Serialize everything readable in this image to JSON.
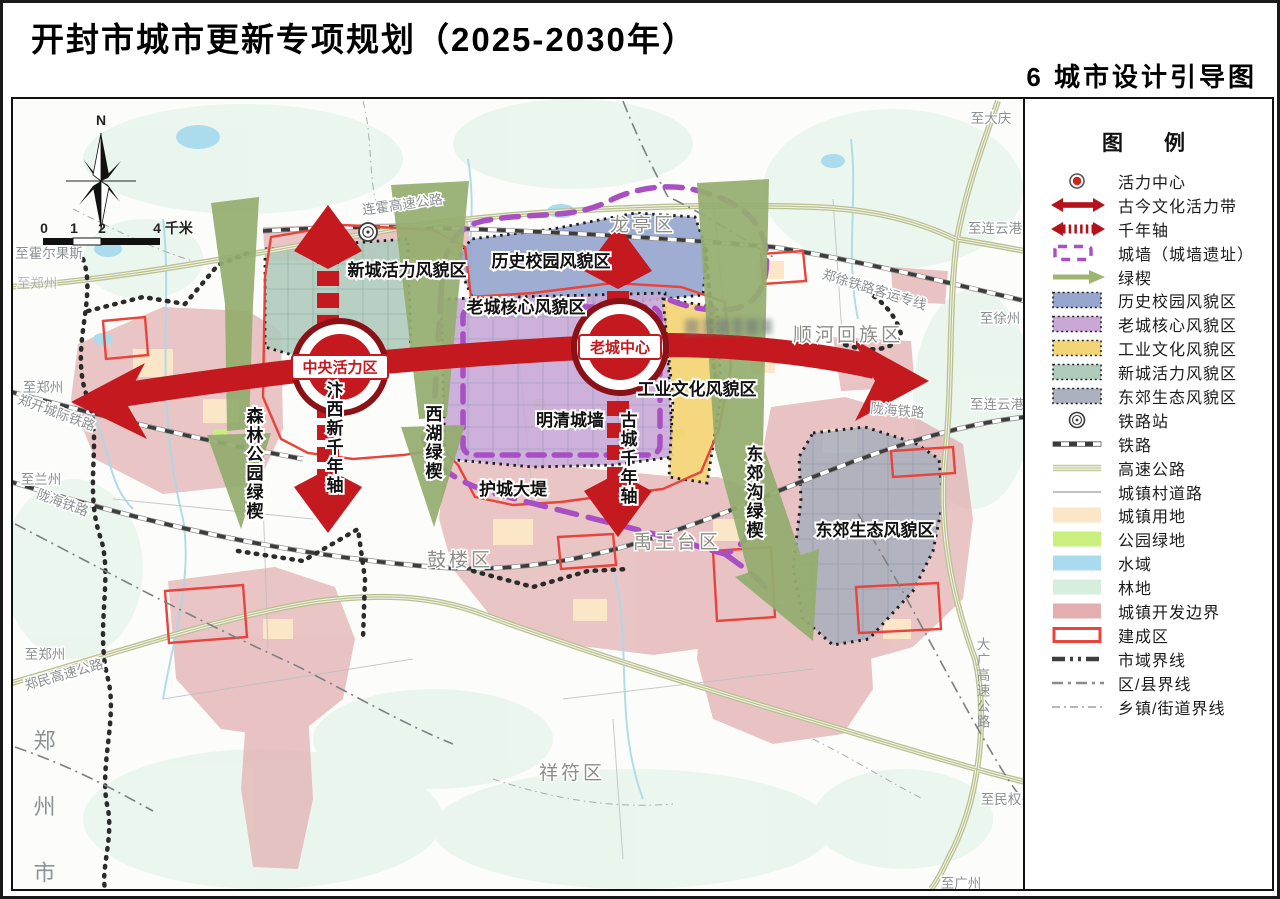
{
  "header": {
    "title": "开封市城市更新专项规划（2025-2030年）",
    "subtitle": "6 城市设计引导图"
  },
  "compass": {
    "north": "N"
  },
  "scale": {
    "t0": "0",
    "t1": "1",
    "t2": "2",
    "t4": "4 千米"
  },
  "map": {
    "zone_new_city": "新城活力风貌区",
    "zone_history_campus": "历史校园风貌区",
    "zone_old_core": "老城核心风貌区",
    "zone_industry": "工业文化风貌区",
    "wall_ming_qing": "明清城墙",
    "wall_moat_dike": "护城大堤",
    "zone_east_eco": "东郊生态风貌区",
    "wedge_forest": "森林公园绿楔",
    "axis_bianxi": "汴西新千年轴",
    "wedge_xihu": "西湖绿楔",
    "axis_gucheng": "古城千年轴",
    "wedge_dongjiaogou": "东郊沟绿楔",
    "center_cbd": "中央活力区",
    "center_old": "老城中心",
    "dist_longting": "龙亭区",
    "dist_shunhe": "顺河回族区",
    "dist_gulou": "鼓楼区",
    "dist_yuwangtai": "禹王台区",
    "dist_xiangfu": "祥符区",
    "city_zhengzhou": "郑州市",
    "rd_lianhuo": "连霍高速公路",
    "rail_zhengxu": "郑徐铁路客运专线",
    "rail_longhai_e": "陇海铁路",
    "rail_longhai_w": "陇海铁路",
    "rail_zhengkai": "郑开城际铁路",
    "rd_zhengmin": "郑民高速公路",
    "rd_daguang": "大广高速公路",
    "to_daqing": "至大庆",
    "to_lianyungang_n": "至连云港",
    "to_xuzhou": "至徐州",
    "to_lianyungang_s": "至连云港",
    "to_minquan": "至民权",
    "to_guangzhou": "至广州",
    "to_huoerguosi": "至霍尔果斯",
    "to_zhengzhou_n": "至郑州",
    "to_zhengzhou_m": "至郑州",
    "to_lanzhou": "至兰州",
    "to_zhengzhou_s": "至郑州"
  },
  "colors": {
    "red_axis": "#c3191f",
    "purple_wall": "#a84fc4",
    "green_wedge": "#94ad6f",
    "zone_history": "#97a6cf",
    "zone_oldcore": "#c9a8d6",
    "zone_industry": "#f3d578",
    "zone_newcity": "#afcbbc",
    "zone_easteco": "#acb0bf",
    "urban_land": "#fbe7c8",
    "park_green": "#c9f07e",
    "water": "#a9daee",
    "forest": "#d5eedd",
    "dev_boundary": "#e2aeb0",
    "built_outline": "#e8443b"
  },
  "legend": {
    "title": "图　例",
    "items": [
      {
        "label": "活力中心",
        "type": "vitality-center"
      },
      {
        "label": "古今文化活力带",
        "type": "culture-belt"
      },
      {
        "label": "千年轴",
        "type": "millennium-axis"
      },
      {
        "label": "城墙（城墙遗址）",
        "type": "city-wall"
      },
      {
        "label": "绿楔",
        "type": "green-wedge"
      },
      {
        "label": "历史校园风貌区",
        "type": "zone",
        "color": "#97a6cf"
      },
      {
        "label": "老城核心风貌区",
        "type": "zone",
        "color": "#c9a8d6"
      },
      {
        "label": "工业文化风貌区",
        "type": "zone",
        "color": "#f3d578"
      },
      {
        "label": "新城活力风貌区",
        "type": "zone",
        "color": "#afcbbc"
      },
      {
        "label": "东郊生态风貌区",
        "type": "zone",
        "color": "#acb0bf"
      },
      {
        "label": "铁路站",
        "type": "rail-station"
      },
      {
        "label": "铁路",
        "type": "railway"
      },
      {
        "label": "高速公路",
        "type": "highway"
      },
      {
        "label": "城镇村道路",
        "type": "town-road"
      },
      {
        "label": "城镇用地",
        "type": "fill",
        "color": "#fbe7c8"
      },
      {
        "label": "公园绿地",
        "type": "fill",
        "color": "#c9f07e"
      },
      {
        "label": "水域",
        "type": "fill",
        "color": "#a9daee"
      },
      {
        "label": "林地",
        "type": "fill",
        "color": "#d5eedd"
      },
      {
        "label": "城镇开发边界",
        "type": "fill",
        "color": "#e2aeb0"
      },
      {
        "label": "建成区",
        "type": "built-area"
      },
      {
        "label": "市域界线",
        "type": "city-boundary"
      },
      {
        "label": "区/县界线",
        "type": "county-boundary"
      },
      {
        "label": "乡镇/街道界线",
        "type": "town-boundary"
      }
    ]
  }
}
